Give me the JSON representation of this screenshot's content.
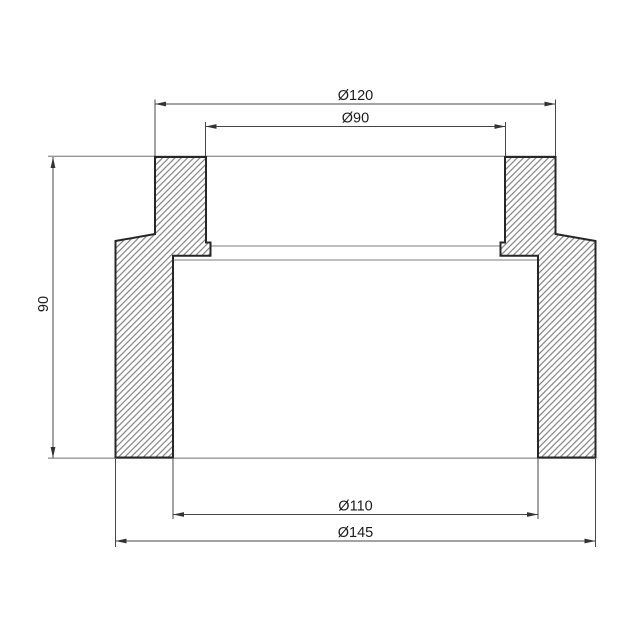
{
  "drawing": {
    "kind": "technical-section-view",
    "dimensions": {
      "top_outer_diameter": {
        "label": "Ø120"
      },
      "top_inner_diameter": {
        "label": "Ø90"
      },
      "bottom_inner_diameter": {
        "label": "Ø110"
      },
      "bottom_outer_diameter": {
        "label": "Ø145"
      },
      "height": {
        "label": "90"
      }
    },
    "colors": {
      "background": "#ffffff",
      "outline": "#272727",
      "hatch_line": "#6b6b6b",
      "edge_line": "#969696",
      "dimension_line": "#474747",
      "arrow_fill": "#333333",
      "text": "#1a1a1a"
    }
  }
}
